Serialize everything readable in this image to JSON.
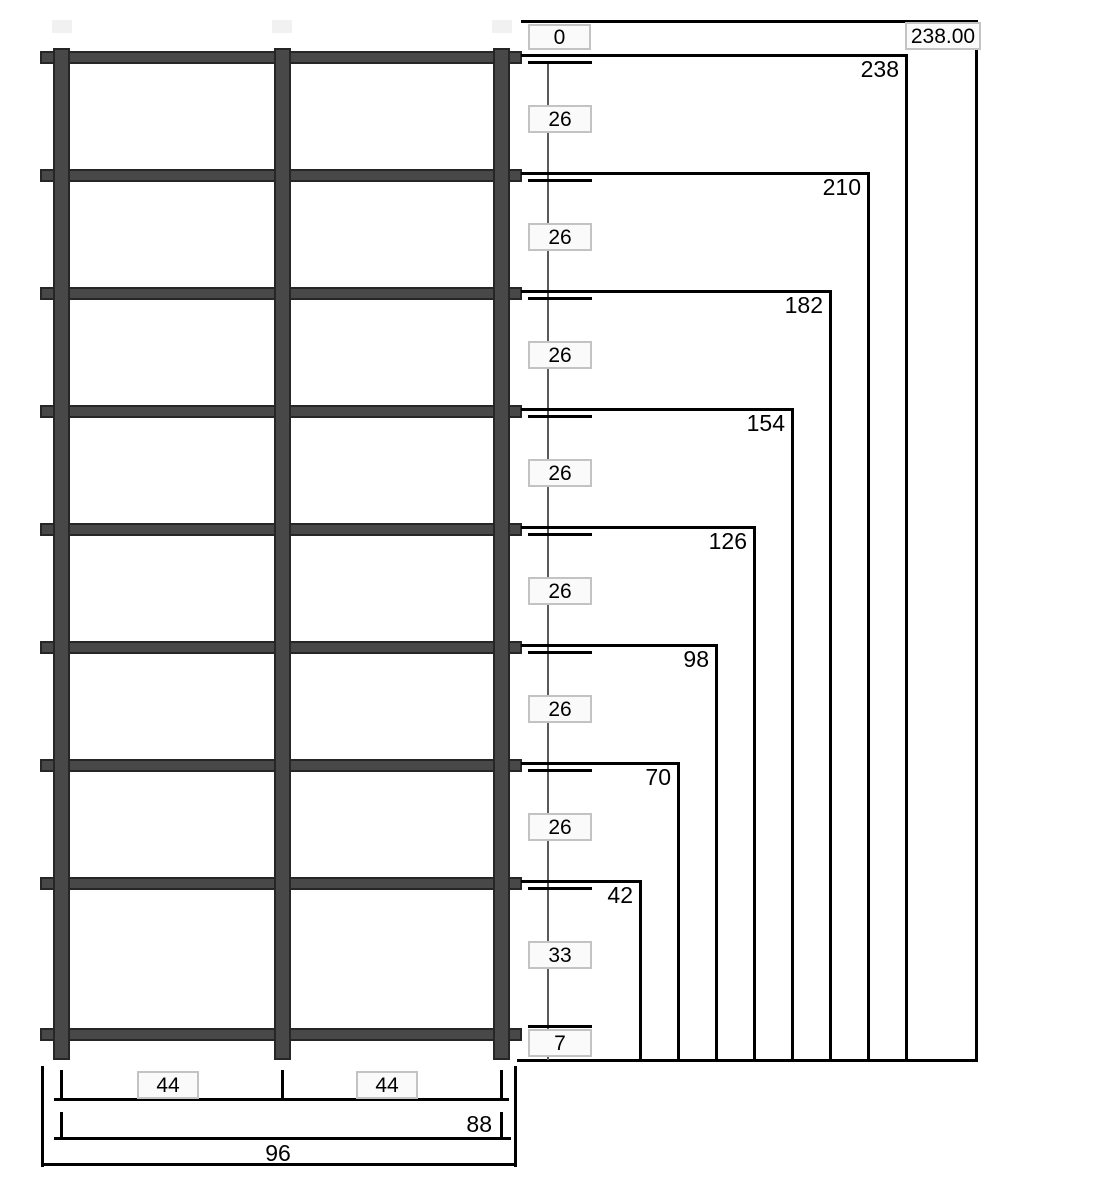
{
  "drawing": {
    "kind": "reinforcement-cage-elevation"
  },
  "colors": {
    "background": "#ffffff",
    "bar_fill": "#484848",
    "bar_border": "#262626",
    "dimension_line": "#000000",
    "leader_line": "#5a5a5a",
    "value_box_fill": "#fafafa",
    "value_box_border": "#c3c3c3",
    "ghost_marker": "#f1f1f1",
    "text": "#000000"
  },
  "vertical_dimension": {
    "origin_value": "0",
    "overall_value": "238.00",
    "segments": [
      "26",
      "26",
      "26",
      "26",
      "26",
      "26",
      "26",
      "33",
      "7"
    ],
    "ordinates": [
      "238",
      "210",
      "182",
      "154",
      "126",
      "98",
      "70",
      "42"
    ]
  },
  "horizontal_dimension": {
    "left_span": "44",
    "right_span": "44",
    "combined_span": "88",
    "overall_span": "96"
  }
}
